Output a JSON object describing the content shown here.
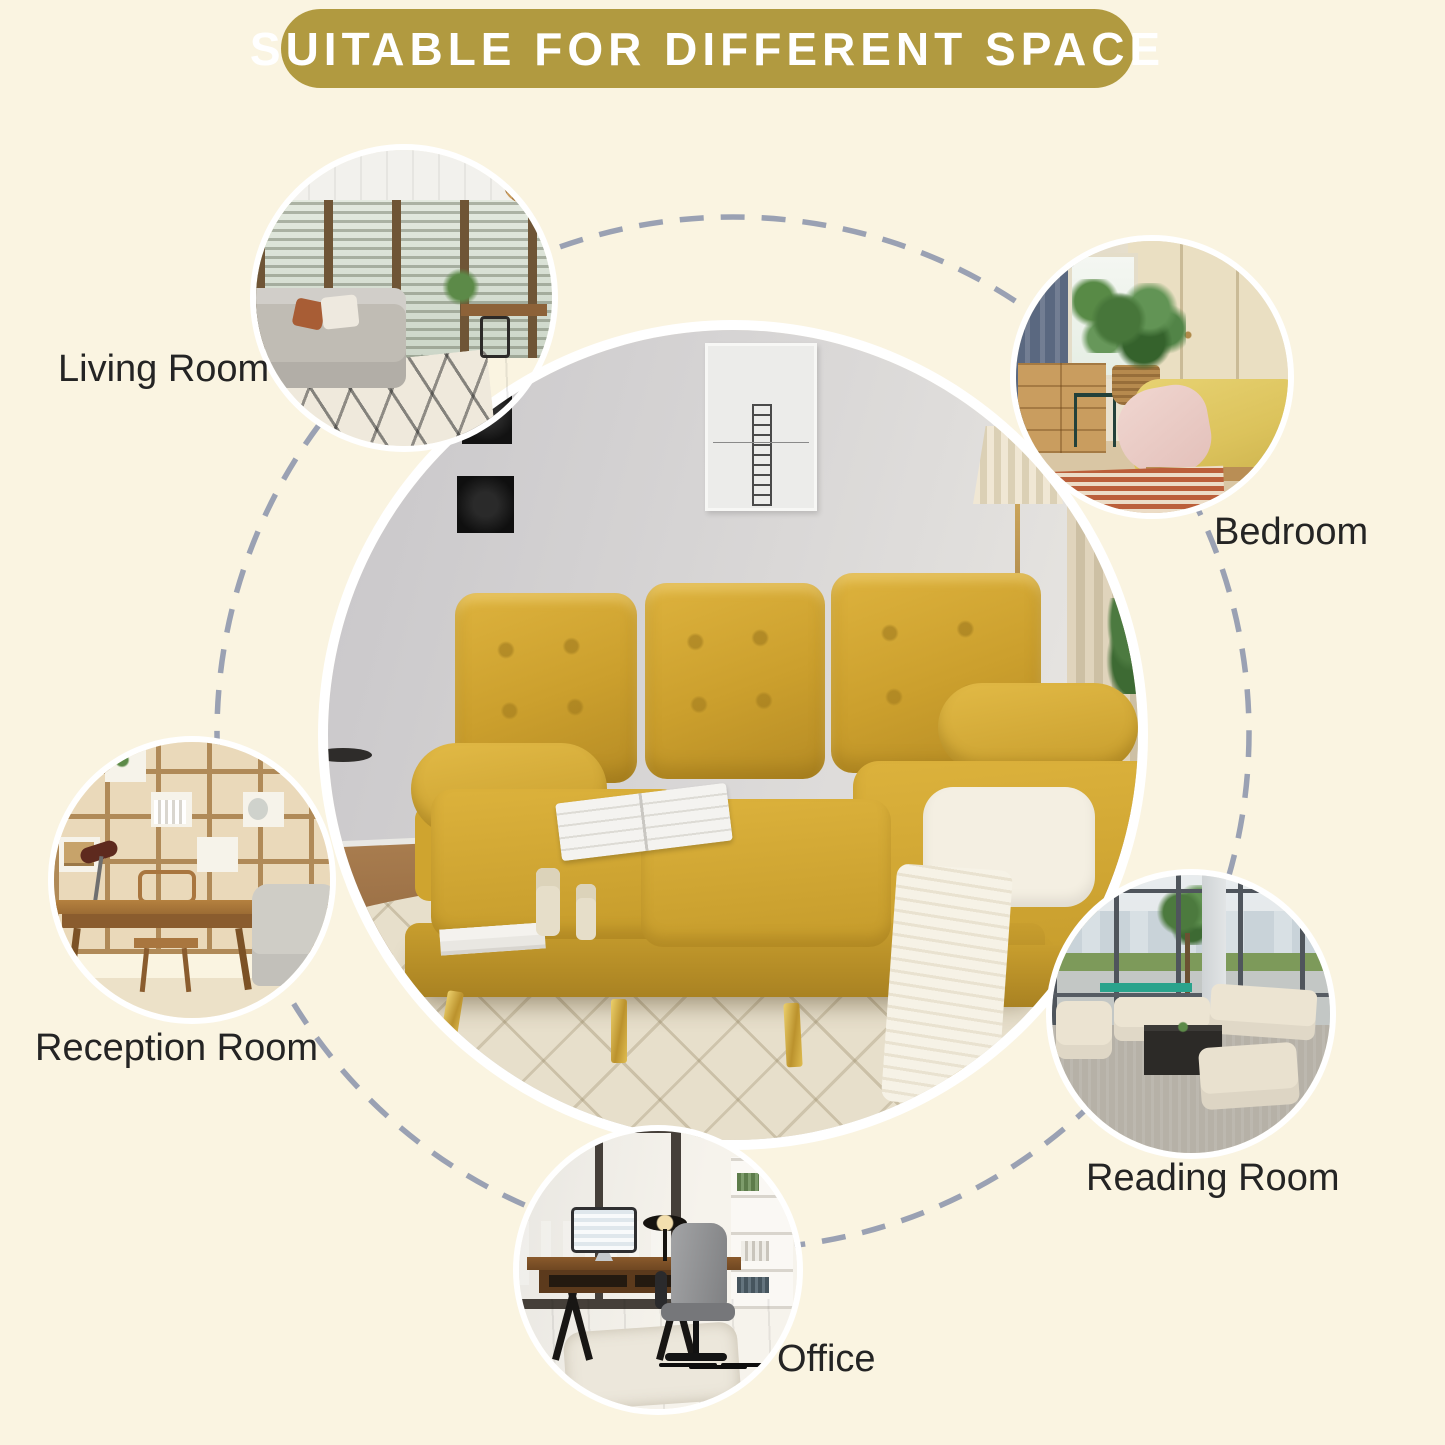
{
  "title": "SUITABLE FOR DIFFERENT SPACE",
  "colors": {
    "background": "#faf4e1",
    "banner": "#b19a40",
    "banner_text": "#ffffff",
    "label": "#242424",
    "dash": "#9aa1b3",
    "sofa_yellow": "#cda22e",
    "ring": "#ffffff"
  },
  "rooms": [
    {
      "id": "living-room",
      "label": "Living Room",
      "photo": "living-room-interior-photo"
    },
    {
      "id": "bedroom",
      "label": "Bedroom",
      "photo": "bedroom-interior-photo"
    },
    {
      "id": "reception-room",
      "label": "Reception Room",
      "photo": "reception-room-interior-photo"
    },
    {
      "id": "reading-room",
      "label": "Reading Room",
      "photo": "reading-room-interior-photo"
    },
    {
      "id": "office",
      "label": "Office",
      "photo": "office-interior-photo"
    }
  ],
  "center_photo": "yellow-sectional-sofa-living-scene"
}
